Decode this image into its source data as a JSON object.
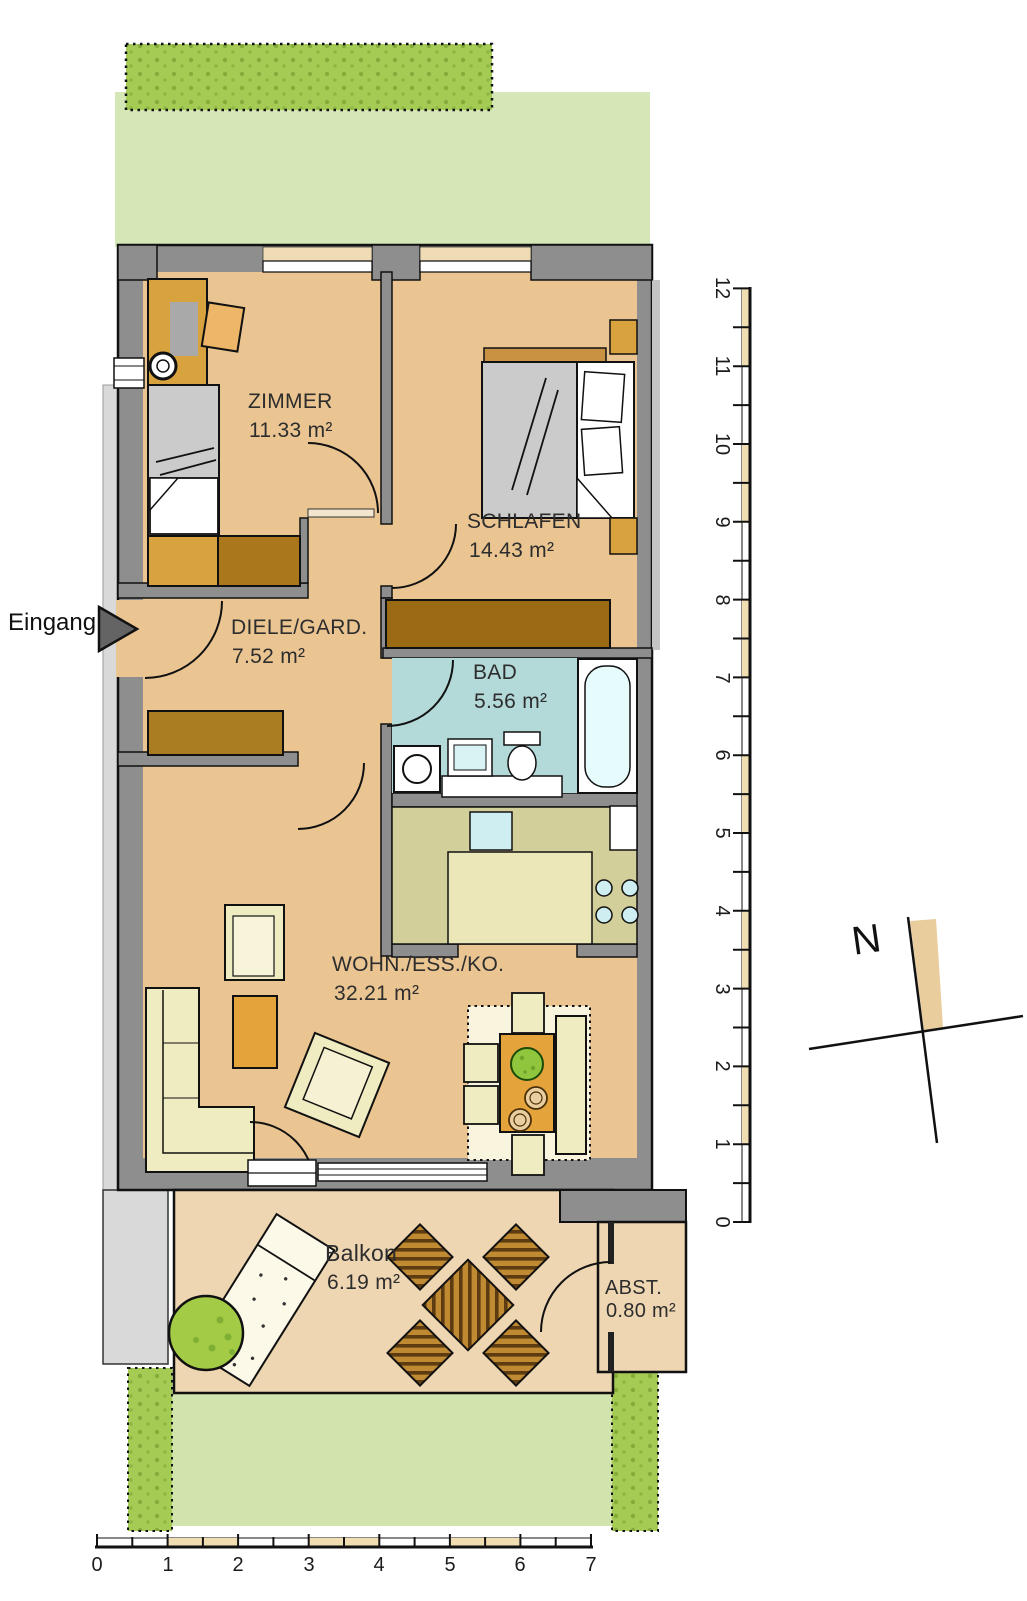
{
  "plan": {
    "type": "apartment-floorplan",
    "entrance_label": "Eingang",
    "compass_north_label": "N"
  },
  "rooms": {
    "zimmer": {
      "name": "ZIMMER",
      "area": "11.33 m²"
    },
    "schlafen": {
      "name": "SCHLAFEN",
      "area": "14.43 m²"
    },
    "diele": {
      "name": "DIELE/GARD.",
      "area": "7.52 m²"
    },
    "bad": {
      "name": "BAD",
      "area": "5.56 m²"
    },
    "wohn": {
      "name": "WOHN./ESS./KO.",
      "area": "32.21 m²"
    },
    "balkon": {
      "name": "Balkon",
      "area": "6.19 m²"
    },
    "abst": {
      "name": "ABST.",
      "area": "0.80 m²"
    }
  },
  "rulers": {
    "vertical_labels": [
      "12",
      "11",
      "10",
      "9",
      "8",
      "7",
      "6",
      "5",
      "4",
      "3",
      "2",
      "1",
      "0"
    ],
    "horizontal_labels": [
      "0",
      "1",
      "2",
      "3",
      "4",
      "5",
      "6",
      "7"
    ]
  },
  "colors": {
    "floor_tan": "#eac592",
    "balcony_tan": "#eed6b2",
    "wall_gray": "#8e8e8e",
    "lawn_green": "#d5e7b7",
    "hedge_green": "#a5cb55",
    "bath_cyan": "#b4d9d9",
    "kitchen_olive": "#d2cf9b",
    "wood_brown": "#b5832f",
    "ruler_tan": "#f0ddb2"
  }
}
